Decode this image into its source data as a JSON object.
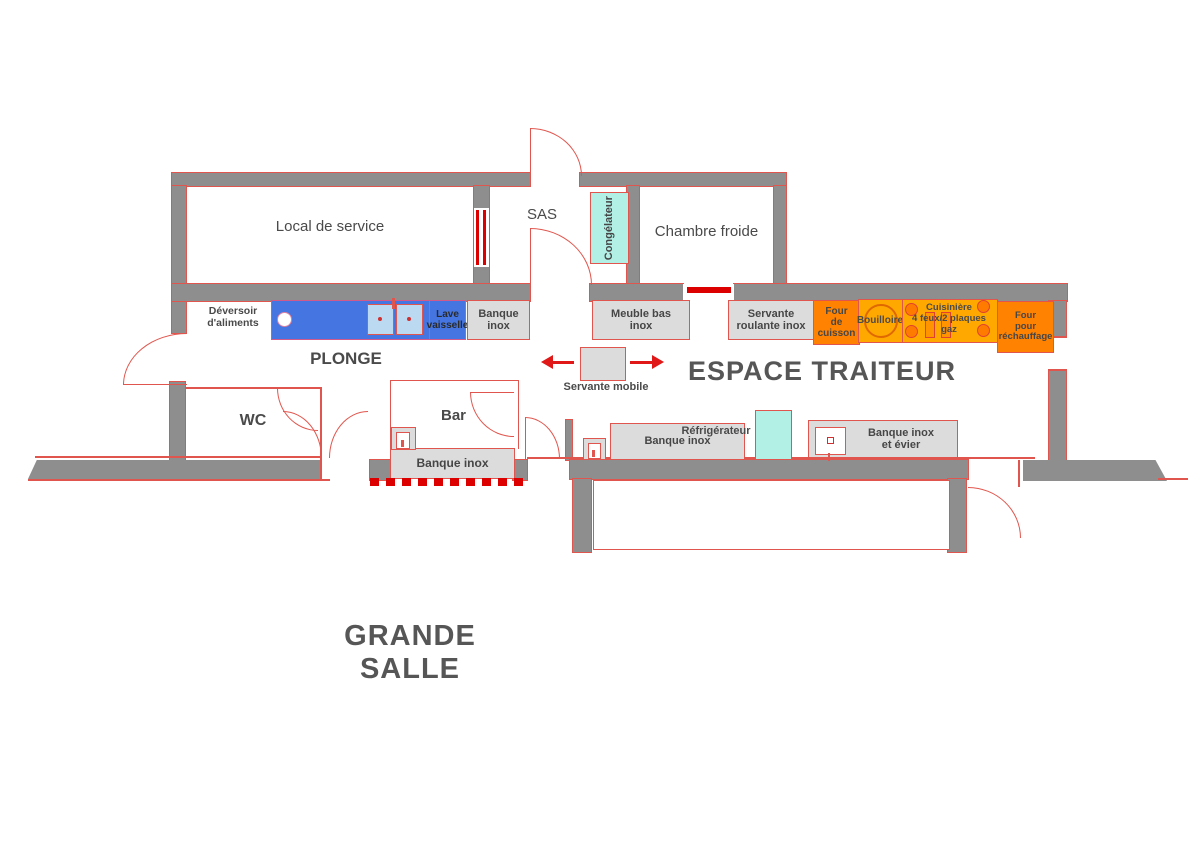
{
  "rooms": {
    "local_de_service": "Local de service",
    "sas": "SAS",
    "chambre_froide": "Chambre froide",
    "wc": "WC",
    "bar": "Bar",
    "plonge": "PLONGE",
    "espace_traiteur": "ESPACE TRAITEUR",
    "grande_salle": "GRANDE SALLE"
  },
  "equipment": {
    "congelateur": "Congélateur",
    "deversoir": "Déversoir\nd'aliments",
    "lave_vaisselle": "Lave\nvaisselle",
    "banque_inox_plonge": "Banque\ninox",
    "meuble_bas_inox": "Meuble bas\ninox",
    "servante_roulante": "Servante\nroulante inox",
    "four_de_cuisson": "Four\nde\ncuisson",
    "bouilloire": "Bouilloire",
    "cuisiniere": "Cuisinière\n4 feux/2 plaques\ngaz",
    "four_rechauffage": "Four\npour\nréchauffage",
    "servante_mobile": "Servante mobile",
    "banque_inox_bar": "Banque inox",
    "banque_inox_traiteur": "Banque inox",
    "refrigerateur": "Réfrigérateur",
    "banque_inox_evier": "Banque inox\net évier"
  },
  "colors": {
    "wall_gray": "#8e8e8e",
    "line_red": "#e0564e",
    "strong_red": "#dd0000",
    "equipment_gray": "#dcdcdc",
    "oven_orange": "#ff8300",
    "stove_amber": "#ffa800",
    "cold_cyan": "#b2f0e6",
    "sink_unit_blue": "#4575e0",
    "basin_blue": "#bcd9f2",
    "text_gray": "#4a4a4a"
  }
}
